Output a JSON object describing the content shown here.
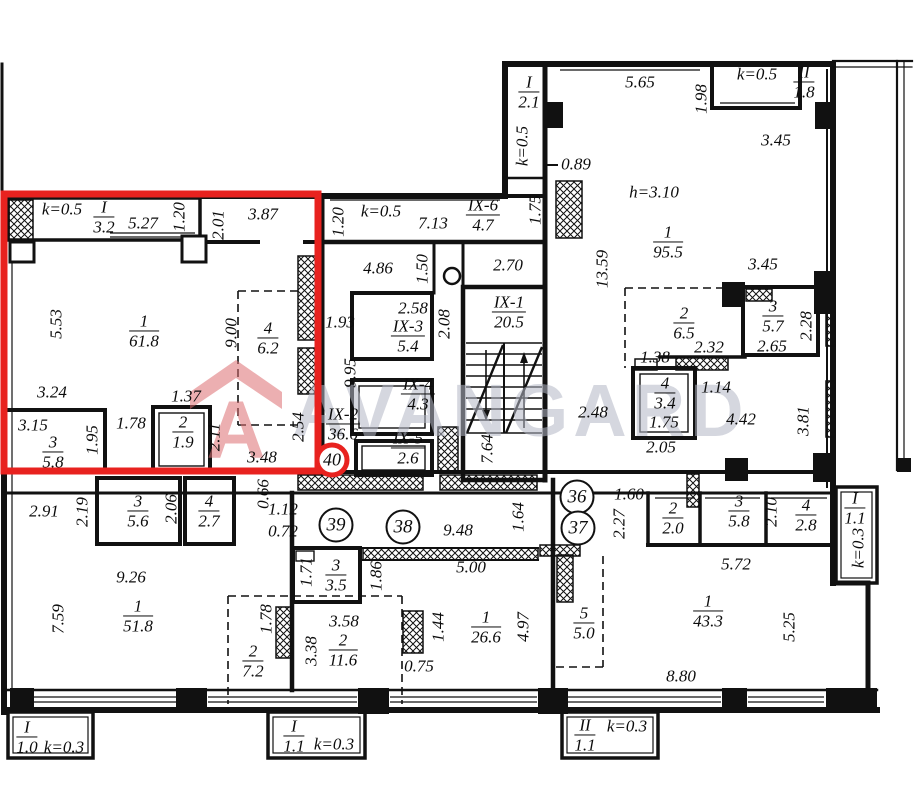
{
  "watermark": {
    "text": "AVANGARD",
    "logo_letter": "A"
  },
  "colors": {
    "highlight_red": "#e8221f",
    "wall_black": "#111111",
    "watermark_gray": "#b4b8c6",
    "watermark_red": "#dd6f72"
  },
  "plan": {
    "highlighted_unit": {
      "number": "40"
    },
    "unit_circles": [
      {
        "label": "40",
        "x": 332,
        "y": 460,
        "highlight": true
      },
      {
        "label": "39",
        "x": 336,
        "y": 525,
        "highlight": false
      },
      {
        "label": "38",
        "x": 403,
        "y": 527,
        "highlight": false
      },
      {
        "label": "36",
        "x": 577,
        "y": 497,
        "highlight": false
      },
      {
        "label": "37",
        "x": 578,
        "y": 528,
        "highlight": false
      }
    ],
    "room_labels": [
      {
        "top": "I",
        "bot": "3.2",
        "x": 104,
        "y": 217
      },
      {
        "top": "1",
        "bot": "61.8",
        "x": 144,
        "y": 331
      },
      {
        "top": "4",
        "bot": "6.2",
        "x": 268,
        "y": 338
      },
      {
        "top": "3",
        "bot": "5.8",
        "x": 53,
        "y": 452
      },
      {
        "top": "2",
        "bot": "1.9",
        "x": 183,
        "y": 432
      },
      {
        "top": "IX-6",
        "bot": "4.7",
        "x": 483,
        "y": 215
      },
      {
        "top": "I",
        "bot": "2.1",
        "x": 529,
        "y": 92
      },
      {
        "top": "II",
        "bot": "1.8",
        "x": 804,
        "y": 82
      },
      {
        "top": "1",
        "bot": "95.5",
        "x": 668,
        "y": 242
      },
      {
        "top": "IX-3",
        "bot": "5.4",
        "x": 408,
        "y": 336
      },
      {
        "top": "IX-1",
        "bot": "20.5",
        "x": 509,
        "y": 312
      },
      {
        "top": "IX-4",
        "bot": "4.3",
        "x": 418,
        "y": 394
      },
      {
        "top": "IX-2",
        "bot": "36.6",
        "x": 343,
        "y": 424
      },
      {
        "top": "IX-5",
        "bot": "2.6",
        "x": 408,
        "y": 448
      },
      {
        "top": "2",
        "bot": "6.5",
        "x": 684,
        "y": 323
      },
      {
        "top": "3",
        "bot": "5.7",
        "x": 773,
        "y": 316
      },
      {
        "top": "4",
        "bot": "3.4",
        "x": 665,
        "y": 393
      },
      {
        "top": "3",
        "bot": "5.6",
        "x": 138,
        "y": 511
      },
      {
        "top": "4",
        "bot": "2.7",
        "x": 209,
        "y": 511
      },
      {
        "top": "1",
        "bot": "51.8",
        "x": 138,
        "y": 616
      },
      {
        "top": "2",
        "bot": "7.2",
        "x": 253,
        "y": 661
      },
      {
        "top": "3",
        "bot": "3.5",
        "x": 336,
        "y": 575
      },
      {
        "top": "2",
        "bot": "11.6",
        "x": 343,
        "y": 650
      },
      {
        "top": "1",
        "bot": "26.6",
        "x": 486,
        "y": 627
      },
      {
        "top": "2",
        "bot": "2.0",
        "x": 673,
        "y": 518
      },
      {
        "top": "3",
        "bot": "5.8",
        "x": 739,
        "y": 511
      },
      {
        "top": "4",
        "bot": "2.8",
        "x": 806,
        "y": 515
      },
      {
        "top": "I",
        "bot": "1.1",
        "x": 855,
        "y": 508
      },
      {
        "top": "1",
        "bot": "43.3",
        "x": 708,
        "y": 611
      },
      {
        "top": "5",
        "bot": "5.0",
        "x": 584,
        "y": 623
      },
      {
        "top": "I",
        "bot": "1.0",
        "x": 27,
        "y": 737
      },
      {
        "top": "I",
        "bot": "1.1",
        "x": 294,
        "y": 736
      },
      {
        "top": "II",
        "bot": "1.1",
        "x": 585,
        "y": 735
      }
    ],
    "dim_labels_h": [
      {
        "t": "k=0.5",
        "x": 62,
        "y": 209
      },
      {
        "t": "5.27",
        "x": 143,
        "y": 223
      },
      {
        "t": "3.87",
        "x": 263,
        "y": 214
      },
      {
        "t": "3.24",
        "x": 52,
        "y": 392
      },
      {
        "t": "1.37",
        "x": 186,
        "y": 396
      },
      {
        "t": "3.15",
        "x": 33,
        "y": 425
      },
      {
        "t": "1.78",
        "x": 131,
        "y": 423
      },
      {
        "t": "3.48",
        "x": 262,
        "y": 457
      },
      {
        "t": "k=0.5",
        "x": 381,
        "y": 211
      },
      {
        "t": "7.13",
        "x": 433,
        "y": 223
      },
      {
        "t": "0.89",
        "x": 576,
        "y": 164
      },
      {
        "t": "4.86",
        "x": 378,
        "y": 268
      },
      {
        "t": "2.70",
        "x": 508,
        "y": 265
      },
      {
        "t": "2.58",
        "x": 413,
        "y": 308
      },
      {
        "t": "1.93",
        "x": 340,
        "y": 322
      },
      {
        "t": "5.65",
        "x": 640,
        "y": 82
      },
      {
        "t": "k=0.5",
        "x": 757,
        "y": 74
      },
      {
        "t": "3.45",
        "x": 776,
        "y": 140
      },
      {
        "t": "h=3.10",
        "x": 654,
        "y": 192
      },
      {
        "t": "3.45",
        "x": 763,
        "y": 264
      },
      {
        "t": "2.32",
        "x": 709,
        "y": 347
      },
      {
        "t": "1.38",
        "x": 655,
        "y": 357
      },
      {
        "t": "2.65",
        "x": 772,
        "y": 346
      },
      {
        "t": "1.14",
        "x": 716,
        "y": 387
      },
      {
        "t": "4.42",
        "x": 741,
        "y": 419
      },
      {
        "t": "2.48",
        "x": 593,
        "y": 412
      },
      {
        "t": "2.05",
        "x": 661,
        "y": 447
      },
      {
        "t": "1.75",
        "x": 664,
        "y": 422
      },
      {
        "t": "2.91",
        "x": 44,
        "y": 511
      },
      {
        "t": "1.12",
        "x": 283,
        "y": 509
      },
      {
        "t": "0.72",
        "x": 283,
        "y": 531
      },
      {
        "t": "9.26",
        "x": 131,
        "y": 577
      },
      {
        "t": "9.48",
        "x": 458,
        "y": 530
      },
      {
        "t": "5.00",
        "x": 471,
        "y": 567
      },
      {
        "t": "1.60",
        "x": 629,
        "y": 494
      },
      {
        "t": "5.72",
        "x": 736,
        "y": 564
      },
      {
        "t": "3.58",
        "x": 344,
        "y": 621
      },
      {
        "t": "0.75",
        "x": 419,
        "y": 666
      },
      {
        "t": "8.80",
        "x": 681,
        "y": 676
      },
      {
        "t": "k=0.3",
        "x": 64,
        "y": 747
      },
      {
        "t": "k=0.3",
        "x": 334,
        "y": 744
      },
      {
        "t": "k=0.3",
        "x": 627,
        "y": 726
      }
    ],
    "dim_labels_v": [
      {
        "t": "1.20",
        "x": 179,
        "y": 217
      },
      {
        "t": "2.01",
        "x": 218,
        "y": 225
      },
      {
        "t": "5.53",
        "x": 56,
        "y": 324
      },
      {
        "t": "9.00",
        "x": 231,
        "y": 333
      },
      {
        "t": "1.95",
        "x": 92,
        "y": 440
      },
      {
        "t": "2.11",
        "x": 214,
        "y": 437
      },
      {
        "t": "2.54",
        "x": 298,
        "y": 427
      },
      {
        "t": "1.20",
        "x": 338,
        "y": 222
      },
      {
        "t": "k=0.5",
        "x": 522,
        "y": 146
      },
      {
        "t": "1.75",
        "x": 535,
        "y": 210
      },
      {
        "t": "1.50",
        "x": 422,
        "y": 269
      },
      {
        "t": "2.08",
        "x": 444,
        "y": 324
      },
      {
        "t": "9.95",
        "x": 350,
        "y": 373
      },
      {
        "t": "7.64",
        "x": 487,
        "y": 449
      },
      {
        "t": "1.98",
        "x": 701,
        "y": 99
      },
      {
        "t": "13.59",
        "x": 602,
        "y": 269
      },
      {
        "t": "2.28",
        "x": 806,
        "y": 326
      },
      {
        "t": "3.81",
        "x": 803,
        "y": 421
      },
      {
        "t": "2.19",
        "x": 82,
        "y": 512
      },
      {
        "t": "2.06",
        "x": 171,
        "y": 509
      },
      {
        "t": "0.66",
        "x": 263,
        "y": 494
      },
      {
        "t": "7.59",
        "x": 58,
        "y": 619
      },
      {
        "t": "1.78",
        "x": 266,
        "y": 619
      },
      {
        "t": "1.71",
        "x": 306,
        "y": 572
      },
      {
        "t": "1.86",
        "x": 376,
        "y": 576
      },
      {
        "t": "3.38",
        "x": 311,
        "y": 651
      },
      {
        "t": "1.44",
        "x": 438,
        "y": 627
      },
      {
        "t": "4.97",
        "x": 523,
        "y": 627
      },
      {
        "t": "1.64",
        "x": 518,
        "y": 517
      },
      {
        "t": "2.27",
        "x": 619,
        "y": 524
      },
      {
        "t": "2.10",
        "x": 771,
        "y": 512
      },
      {
        "t": "5.25",
        "x": 789,
        "y": 627
      },
      {
        "t": "k=0.3",
        "x": 858,
        "y": 548
      }
    ]
  }
}
